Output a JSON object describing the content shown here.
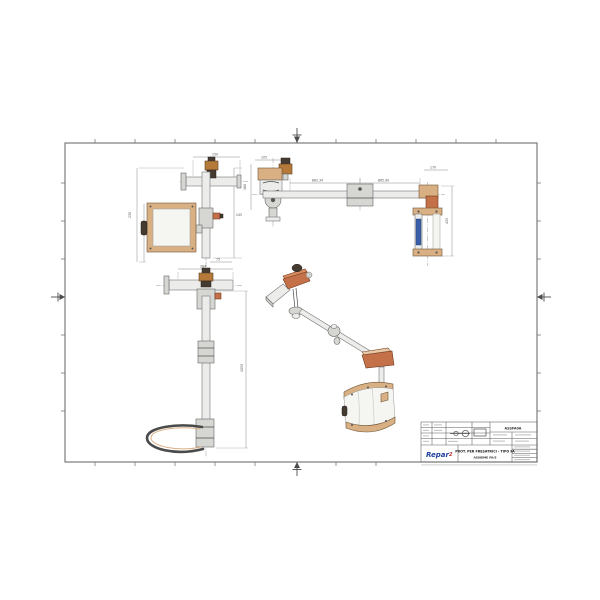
{
  "document": {
    "kind": "scanned technical drawing",
    "language": "Italian",
    "sheet_orientation": "landscape"
  },
  "colors": {
    "paper": "#ffffff",
    "steel": "#ececea",
    "steel_stroke": "#777777",
    "tan": "#d9b084",
    "terracotta": "#c4714a",
    "brass": "#b5793a",
    "dark_part": "#463b31",
    "glass": "#f5f5f1",
    "blue_label": "#3a5fa8",
    "logo_blue": "#1f3f9e",
    "logo_red": "#c03030"
  },
  "dimensions": {
    "plan_top": "150",
    "plan_left": "235",
    "plan_right": "245",
    "plan_bottom": "75",
    "side_left_w": "105",
    "side_left_h": "160",
    "side_span_left": "862.34",
    "side_span_right": "865.90",
    "side_right_w": "170",
    "side_right_h": "425",
    "front_top": "264",
    "front_height": "1055"
  },
  "titleblock": {
    "code": "ASSFA0A",
    "title_line1": "PROT. PER FRESATRICI - TIPO FA",
    "title_line2": "ASSIEME FA/S",
    "logo_text": "Repar",
    "logo_sup": "2"
  }
}
